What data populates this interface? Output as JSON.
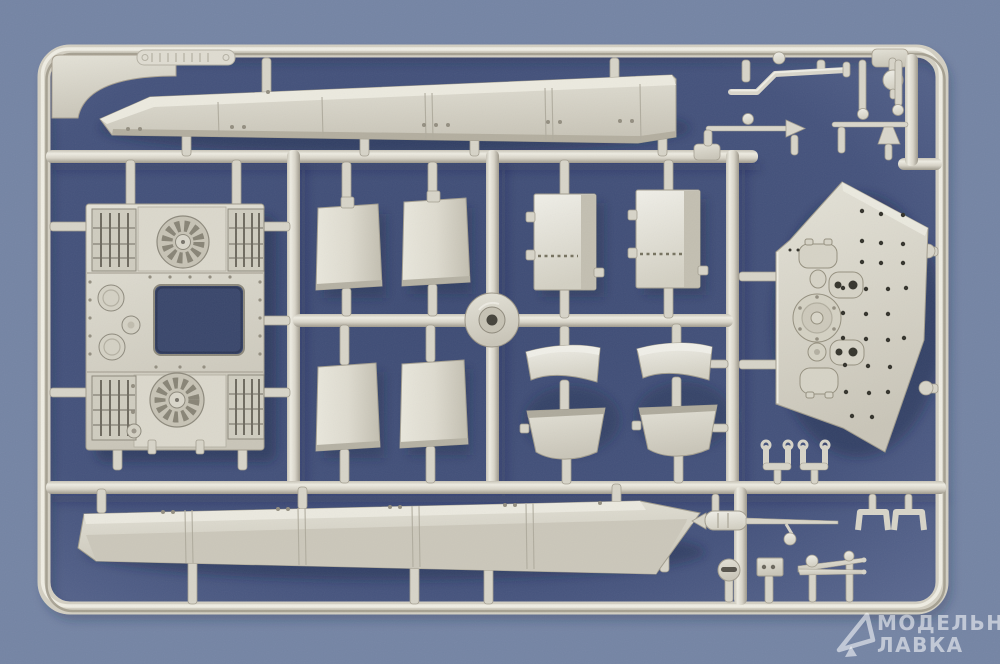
{
  "scene": {
    "subject": "photo of a light-grey injection-molded plastic model sprue with tank parts on blue cloth"
  },
  "watermark": {
    "line1": "МОДЕЛЬНАЯ",
    "line2": "ЛАВКА",
    "logo": "triangle-cursor-icon"
  },
  "parts": [
    "sprue-frame",
    "upper-side-skirt",
    "lower-side-skirt",
    "engine-deck-with-fans",
    "curved-armor-panels",
    "hatch-panels",
    "fender-sections",
    "hull-roof-plate",
    "tool-and-rod-parts",
    "shackle-and-bracket-parts",
    "injection-hub"
  ],
  "colors": {
    "background": "#7383a3",
    "background_inner": "#41507a",
    "plastic": "#d8d5ca",
    "plastic_highlight": "#eeece2",
    "plastic_shadow": "#9d988b",
    "cutout": "#39466b",
    "watermark": "#ffffff"
  }
}
